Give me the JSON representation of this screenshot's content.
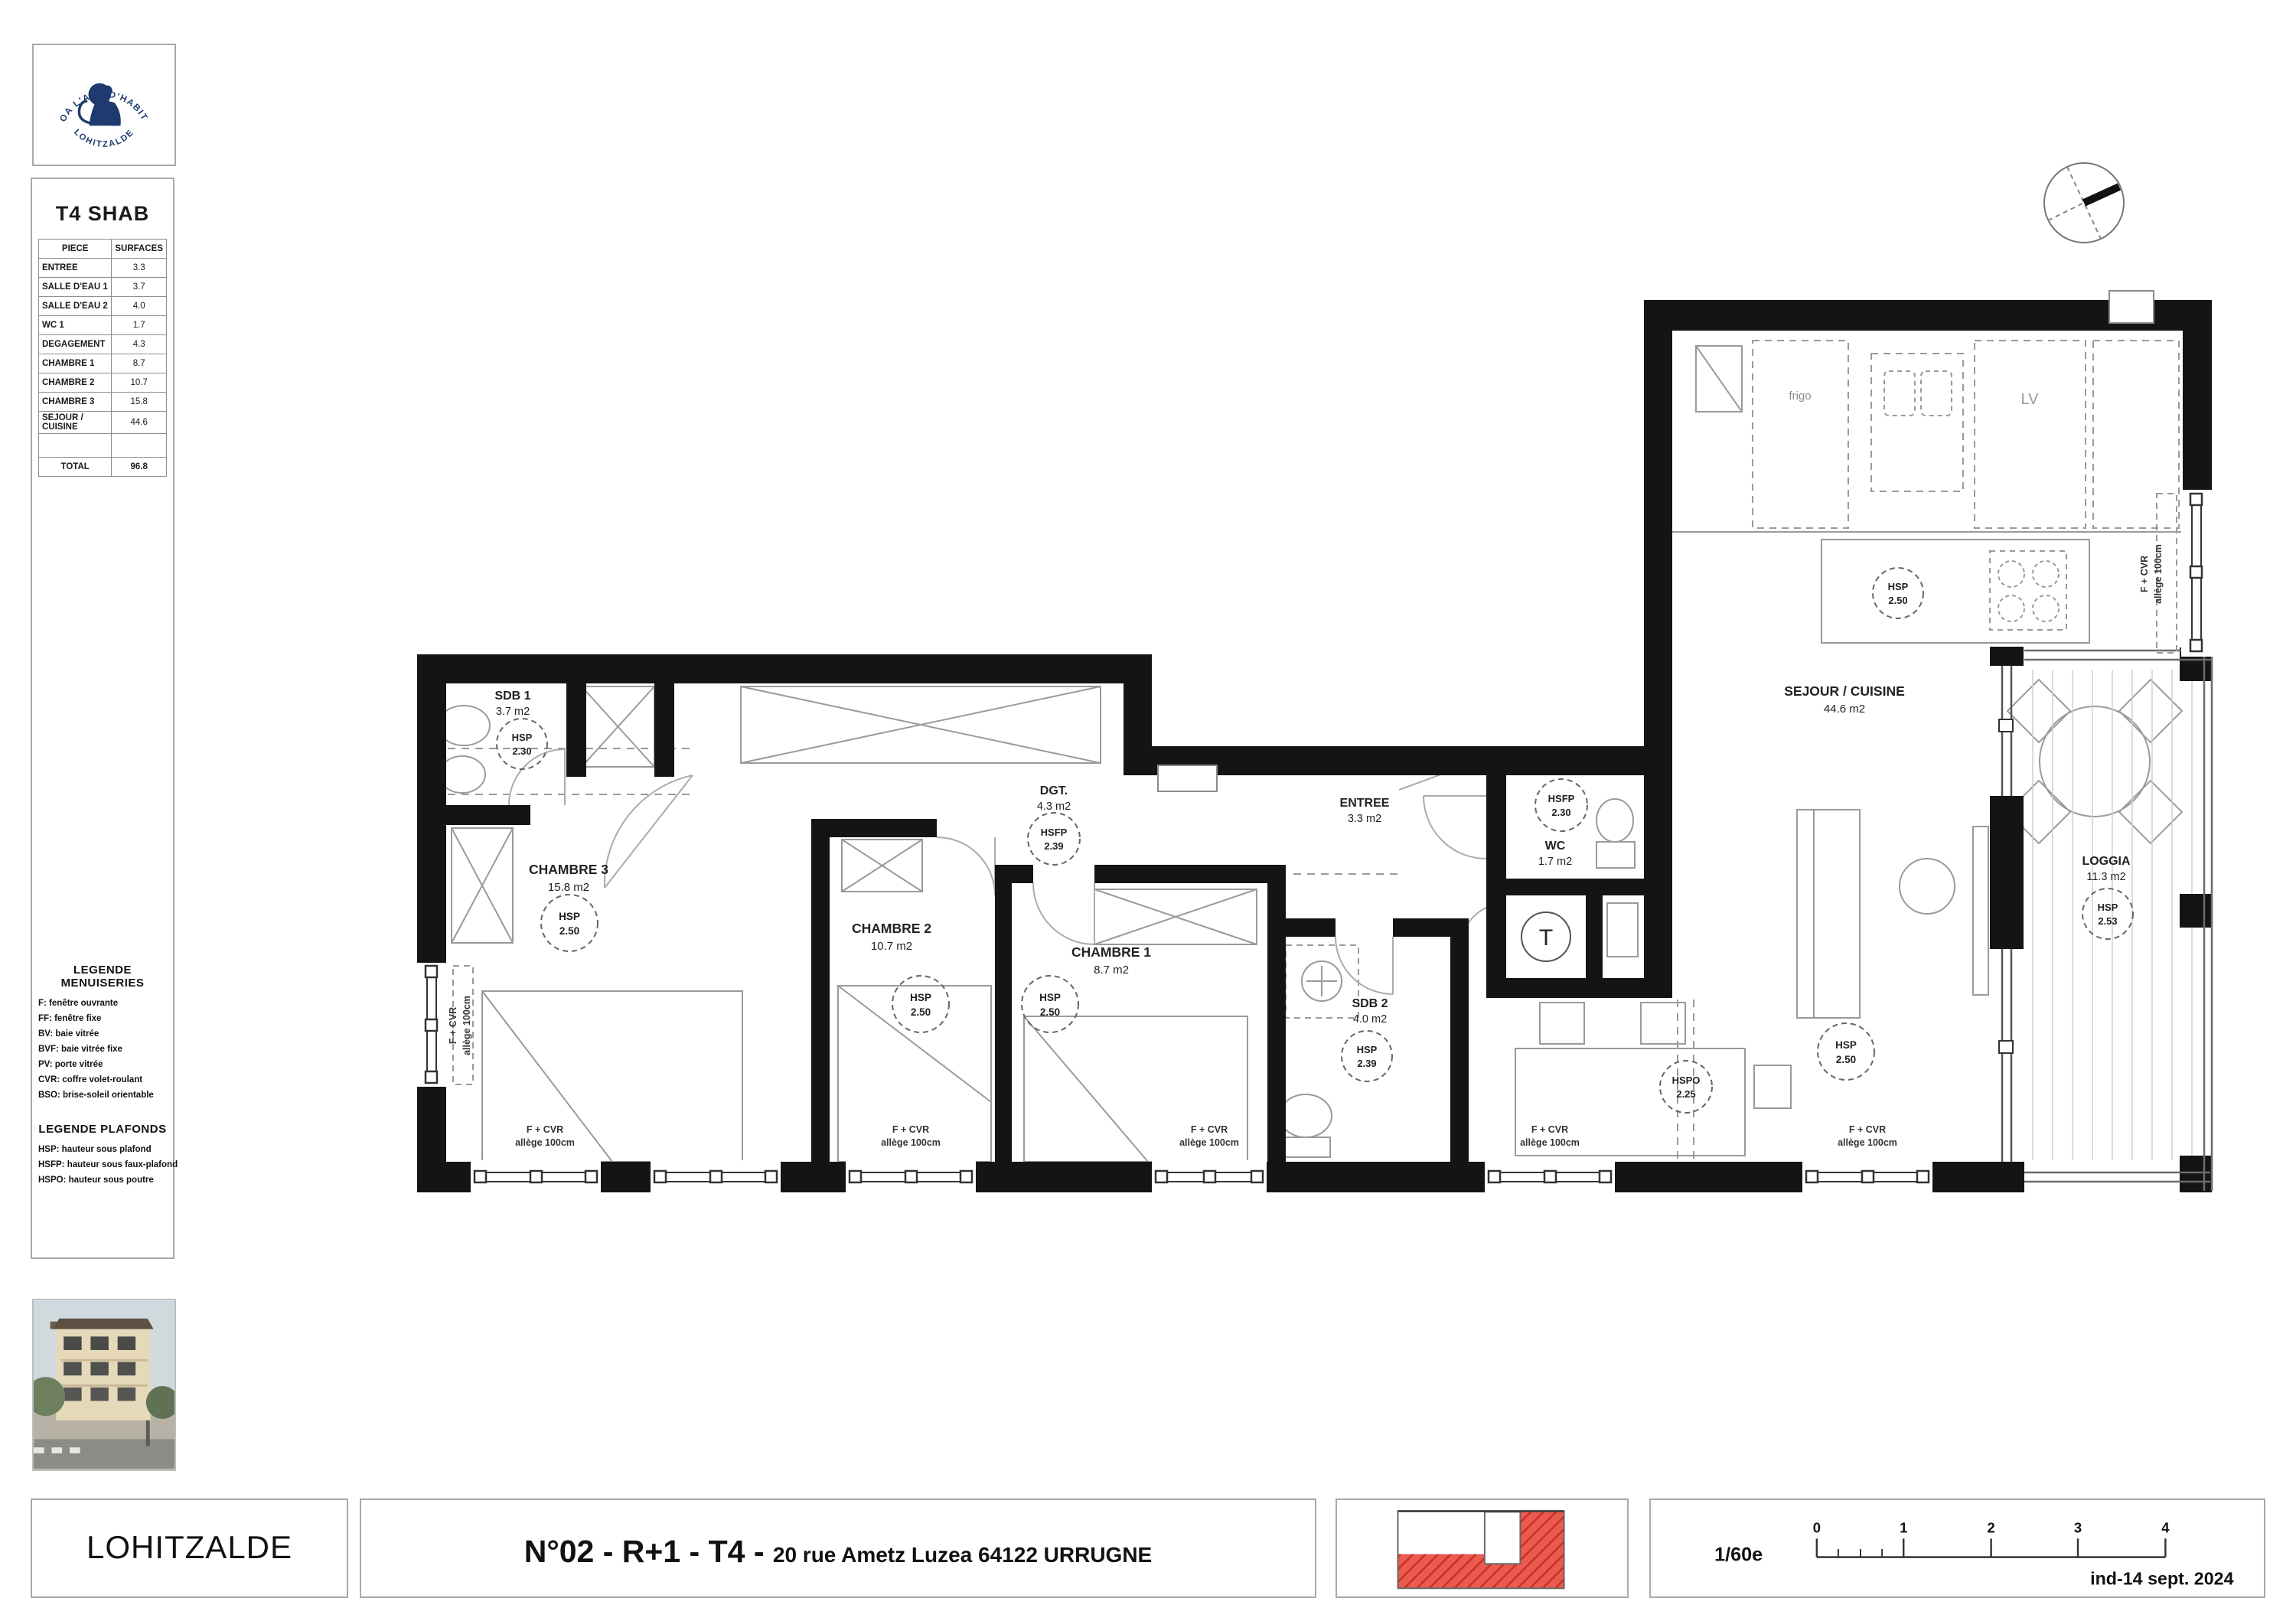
{
  "logo": {
    "arc_top": "STOA  L'ART D'HABITER",
    "arc_bottom": "LOHITZALDE"
  },
  "shab_table": {
    "title": "T4 SHAB",
    "columns": {
      "piece": "PIECE",
      "surfaces": "SURFACES"
    },
    "rows": [
      [
        "ENTREE",
        "3.3"
      ],
      [
        "SALLE D'EAU 1",
        "3.7"
      ],
      [
        "SALLE D'EAU 2",
        "4.0"
      ],
      [
        "WC 1",
        "1.7"
      ],
      [
        "DEGAGEMENT",
        "4.3"
      ],
      [
        "CHAMBRE 1",
        "8.7"
      ],
      [
        "CHAMBRE 2",
        "10.7"
      ],
      [
        "CHAMBRE 3",
        "15.8"
      ],
      [
        "SEJOUR / CUISINE",
        "44.6"
      ]
    ],
    "total_label": "TOTAL",
    "total_value": "96.8"
  },
  "legends": {
    "menuiseries": {
      "title": "LEGENDE MENUISERIES",
      "items": [
        "F: fenêtre ouvrante",
        "FF: fenêtre fixe",
        "BV: baie vitrée",
        "BVF: baie vitrée fixe",
        "PV: porte vitrée",
        "CVR: coffre volet-roulant",
        "BSO: brise-soleil orientable"
      ]
    },
    "plafonds": {
      "title": "LEGENDE PLAFONDS",
      "items": [
        "HSP: hauteur sous plafond",
        "HSFP: hauteur sous faux-plafond",
        "HSPO: hauteur sous poutre"
      ]
    }
  },
  "plan": {
    "rooms": [
      {
        "name": "SDB 1",
        "area": "3.7 m2",
        "h_label": "HSP",
        "h_value": "2.30"
      },
      {
        "name": "CHAMBRE 3",
        "area": "15.8 m2",
        "h_label": "HSP",
        "h_value": "2.50"
      },
      {
        "name": "CHAMBRE 2",
        "area": "10.7 m2",
        "h_label": "HSP",
        "h_value": "2.50"
      },
      {
        "name": "CHAMBRE 1",
        "area": "8.7 m2",
        "h_label": "HSP",
        "h_value": "2.50"
      },
      {
        "name": "DGT.",
        "area": "4.3 m2",
        "h_label": "HSFP",
        "h_value": "2.39"
      },
      {
        "name": "ENTREE",
        "area": "3.3 m2"
      },
      {
        "name": "WC",
        "area": "1.7 m2",
        "h_label": "HSFP",
        "h_value": "2.30"
      },
      {
        "name": "SDB 2",
        "area": "4.0 m2",
        "h_label": "HSP",
        "h_value": "2.39"
      },
      {
        "name": "SEJOUR / CUISINE",
        "area": "44.6 m2",
        "h_label": "HSP",
        "h_value": "2.50"
      },
      {
        "name": "LOGGIA",
        "area": "11.3 m2",
        "h_label": "HSP",
        "h_value": "2.53"
      }
    ],
    "extra_heights": {
      "island": {
        "h_label": "HSP",
        "h_value": "2.50"
      },
      "beam": {
        "h_label": "HSPO",
        "h_value": "2.25"
      }
    },
    "window_label": {
      "line1": "F + CVR",
      "line2": "allège 100cm"
    },
    "kitchen": {
      "fridge": "frigo",
      "dishwasher": "LV"
    },
    "tech_label": "T"
  },
  "footer": {
    "lot": "LOHITZALDE",
    "title_main": "N°02 - R+1 - T4",
    "title_sep": " - ",
    "address": "20 rue Ametz Luzea 64122 URRUGNE",
    "scale_label": "1/60e",
    "scale_ticks": [
      "0",
      "1",
      "2",
      "3",
      "4"
    ],
    "revision": "ind-14 sept. 2024"
  }
}
